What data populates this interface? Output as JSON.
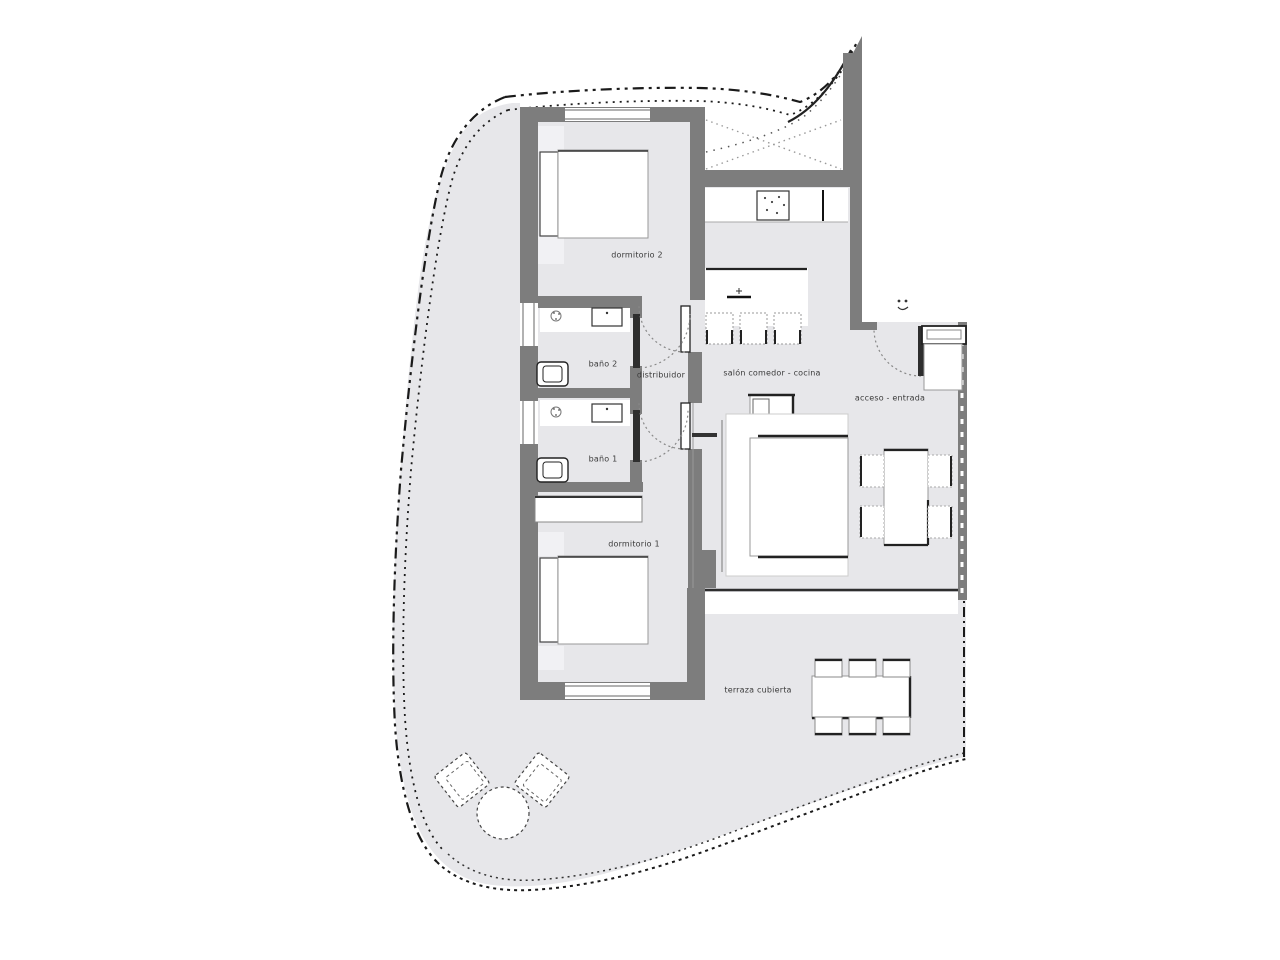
{
  "document": {
    "type": "architectural floor plan"
  },
  "colors": {
    "wall": "#7d7d7d",
    "floor": "#e7e7ea",
    "pale": "#f1f1f4",
    "line": "#2e2e2e",
    "boundary": "#1a1a1a",
    "furniture": "#ffffff"
  },
  "rooms": {
    "bedroom2": {
      "label": "dormitorio 2"
    },
    "bath2": {
      "label": "baño 2"
    },
    "hall": {
      "label": "distribuidor"
    },
    "living": {
      "label": "salón comedor - cocina"
    },
    "entry": {
      "label": "acceso - entrada"
    },
    "bath1": {
      "label": "baño 1"
    },
    "bedroom1": {
      "label": "dormitorio 1"
    },
    "terrace": {
      "label": "terraza cubierta"
    }
  }
}
